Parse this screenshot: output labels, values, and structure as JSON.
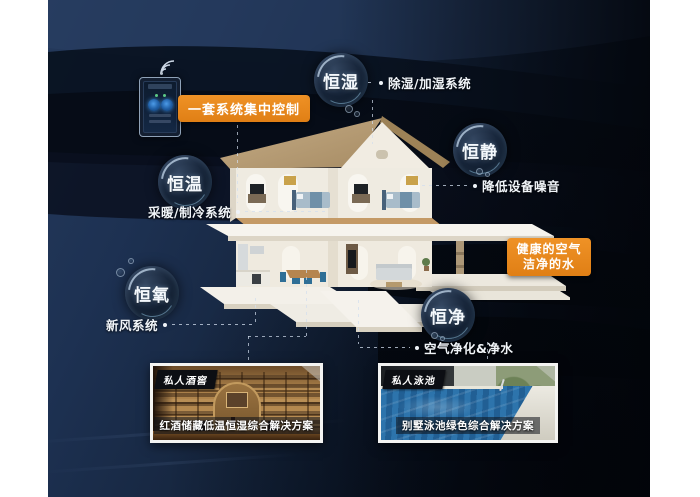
{
  "callouts": {
    "control": "一套系统集中控制",
    "healthy_line1": "健康的空气",
    "healthy_line2": "洁净的水"
  },
  "bubbles": [
    {
      "id": "heng-shi",
      "label": "恒湿",
      "desc": "除湿/加湿系统"
    },
    {
      "id": "heng-jing",
      "label": "恒静",
      "desc": "降低设备噪音"
    },
    {
      "id": "heng-wen",
      "label": "恒温",
      "desc": "采暖/制冷系统"
    },
    {
      "id": "heng-yang",
      "label": "恒氧",
      "desc": "新风系统"
    },
    {
      "id": "heng-jing2",
      "label": "恒净",
      "desc": "空气净化&净水"
    }
  ],
  "panels": [
    {
      "tag": "私人酒窖",
      "caption": "红酒储藏低温恒湿综合解决方案"
    },
    {
      "tag": "私人泳池",
      "caption": "别墅泳池绿色综合解决方案"
    }
  ],
  "icons": {
    "wifi": "wifi-icon",
    "controller_phone": "smart-panel-phone-icon"
  },
  "colors": {
    "accent_orange": "#e8871e",
    "background_navy": "#16263f",
    "bubble_dark": "#0b1626"
  }
}
